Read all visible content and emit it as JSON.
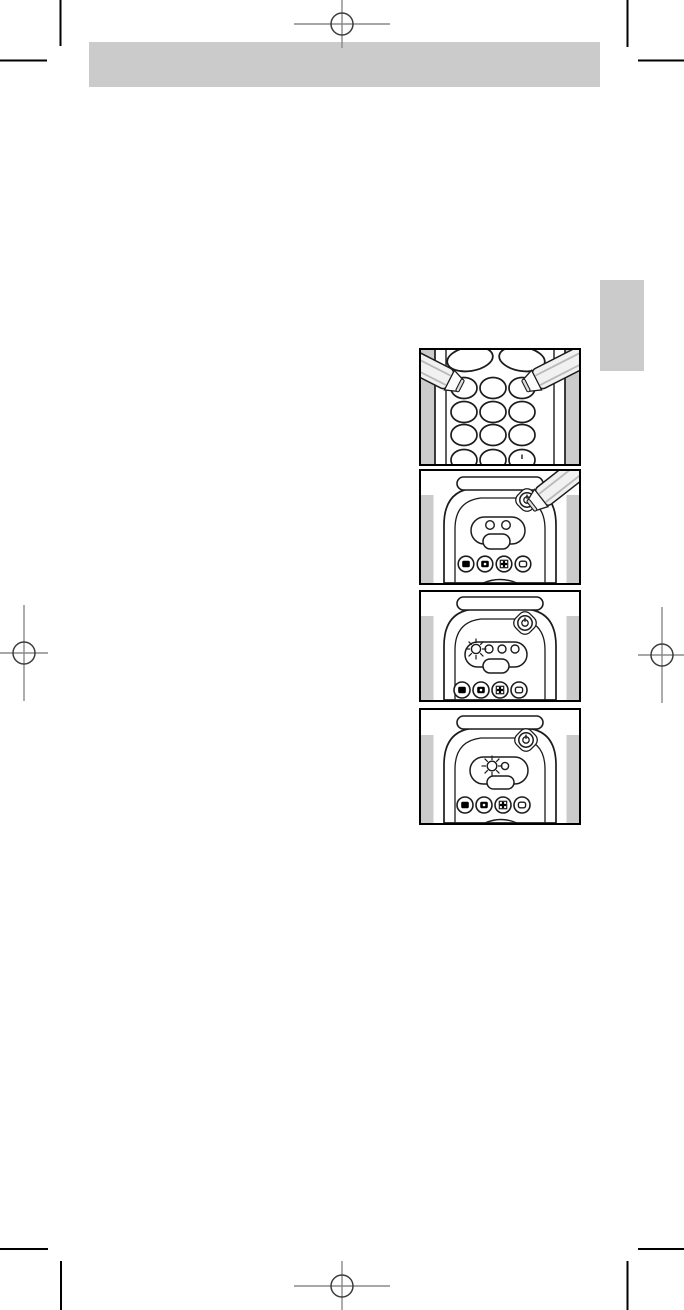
{
  "page": {
    "type": "printed-manual-page",
    "visible_text": ""
  },
  "colors": {
    "page-bg": "#ffffff",
    "bar-gray": "#cbcbcb",
    "figure-gray": "#cbcbcb",
    "ink": "#000000",
    "drawing-line": "#1c1c1c",
    "reg-line": "#8a8a8a",
    "reg-circle": "#3c3c3c",
    "pen-fill": "#f1f1f1",
    "pen-shade": "#b9b9b9",
    "pen-tip": "#e0e0e0"
  },
  "print_marks": {
    "registration_positions": [
      "top-center",
      "middle-left",
      "middle-right",
      "bottom-center"
    ],
    "trim_corner_positions": [
      "top-left",
      "top-right",
      "bottom-left",
      "bottom-right"
    ]
  },
  "figures": [
    {
      "name": "figure-press-two-keypad-buttons",
      "elements": [
        "remote-keypad",
        "rocker-buttons",
        "keypad-button-grid",
        "pen-left-icon",
        "pen-right-icon"
      ]
    },
    {
      "name": "figure-pen-pressing-standby-button",
      "elements": [
        "remote-top",
        "standby-button-icon",
        "indicator-cluster",
        "ok-pill-button",
        "pen-icon",
        "tv-button-icon",
        "vcr-button-icon",
        "sat-button-icon",
        "aux-button-icon"
      ]
    },
    {
      "name": "figure-led-blinking-row-of-four",
      "elements": [
        "remote-top",
        "standby-button-icon",
        "blinking-led-icon",
        "indicator-cluster",
        "ok-pill-button",
        "tv-button-icon",
        "vcr-button-icon",
        "sat-button-icon",
        "aux-button-icon"
      ]
    },
    {
      "name": "figure-led-blinking-pair",
      "elements": [
        "remote-top",
        "standby-button-icon",
        "blinking-led-icon",
        "indicator-cluster",
        "ok-pill-button",
        "tv-button-icon",
        "vcr-button-icon",
        "sat-button-icon",
        "aux-button-icon"
      ]
    }
  ]
}
